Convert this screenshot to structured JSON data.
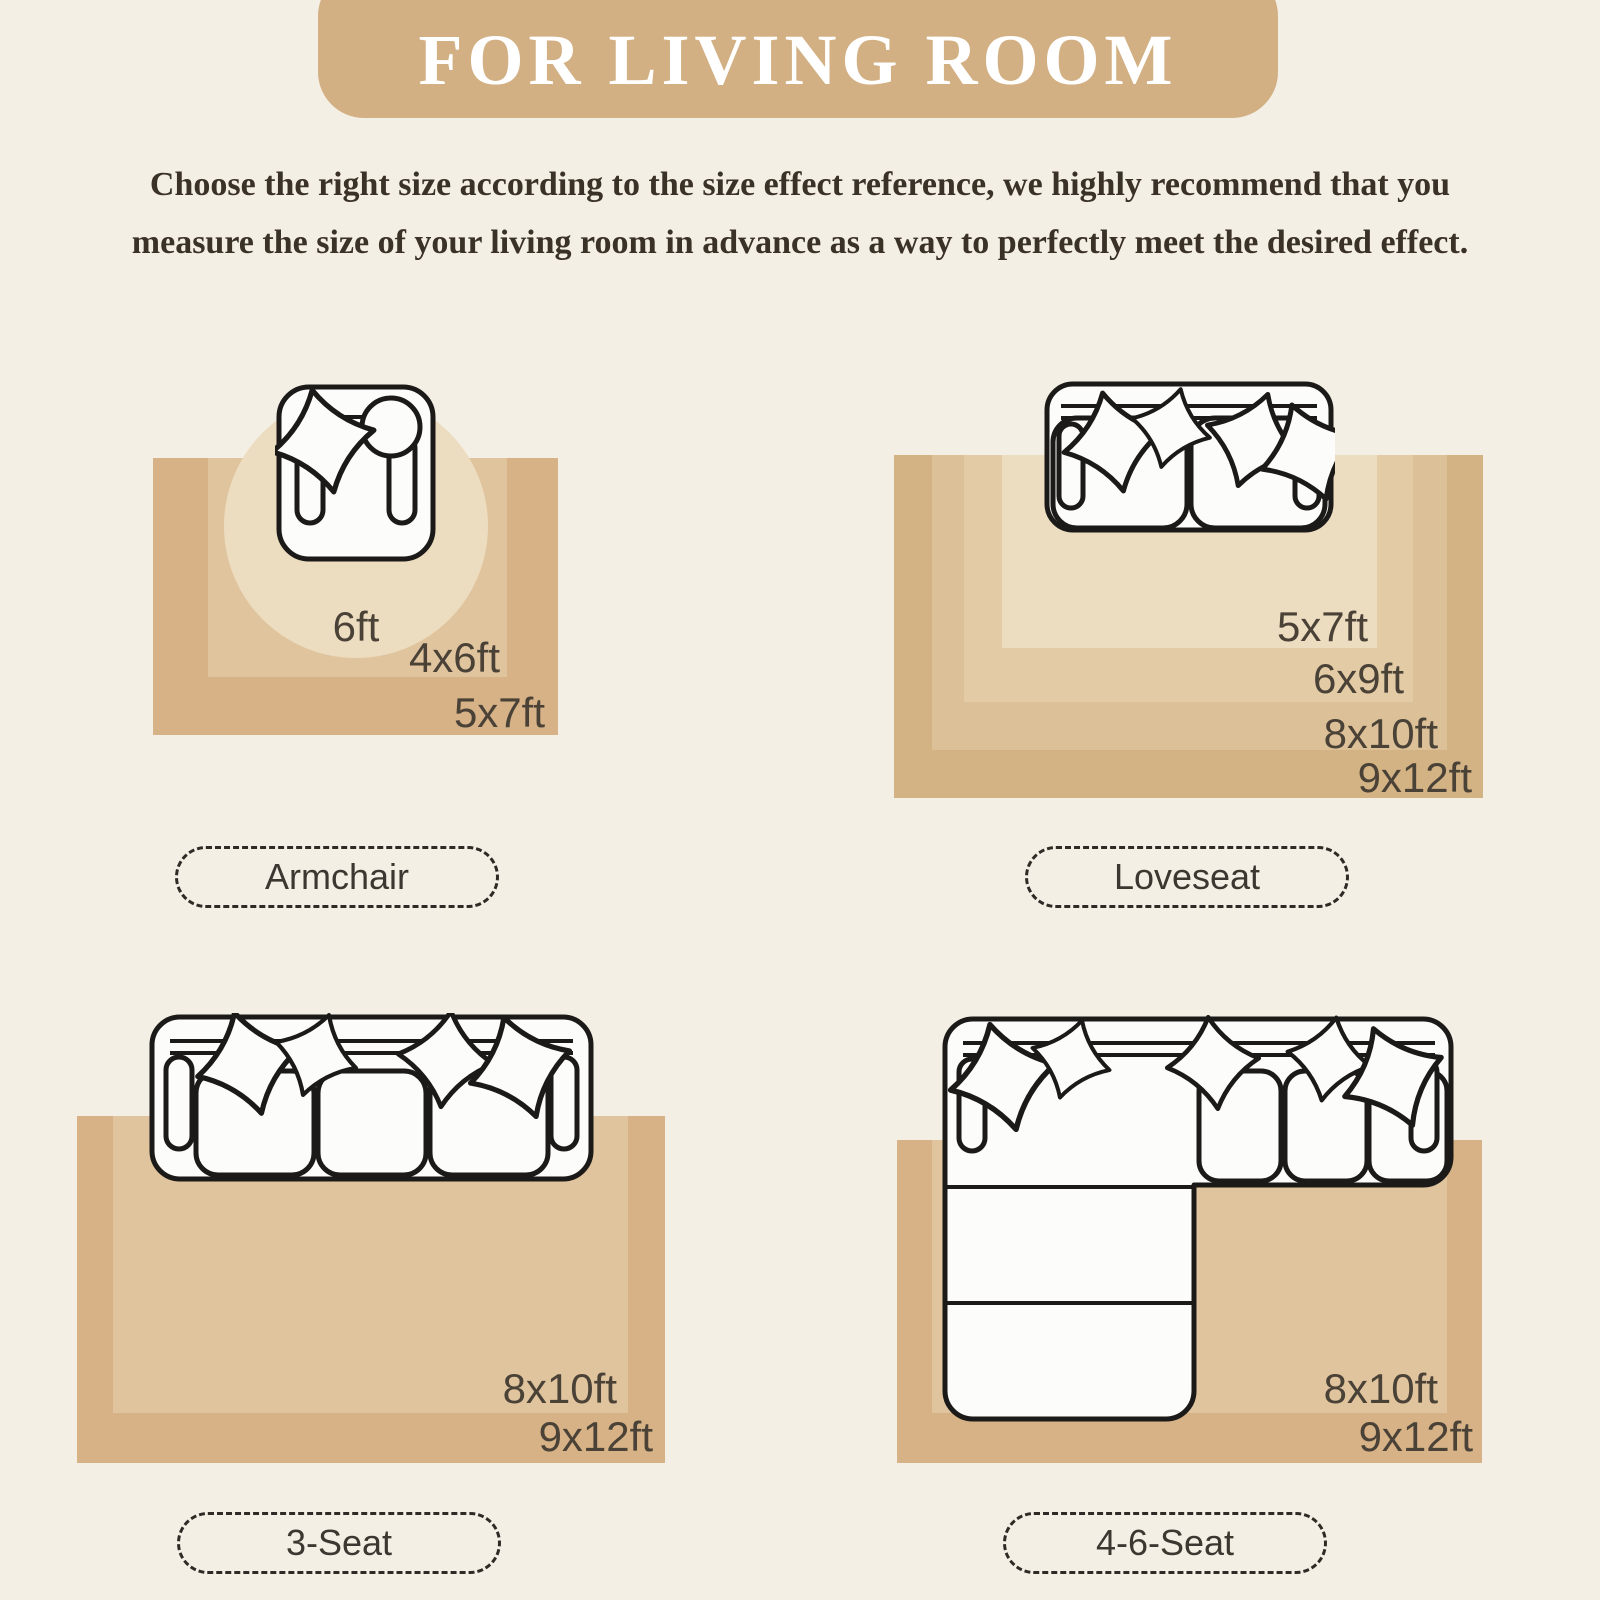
{
  "header": {
    "title": "FOR LIVING ROOM"
  },
  "intro": {
    "line1": "Choose the right size according to the size effect reference, we highly recommend that you",
    "line2": "measure the size of your living room in advance as a way to perfectly meet the desired effect."
  },
  "quadrants": {
    "armchair": {
      "label": "Armchair",
      "sizes": {
        "s1": "6ft",
        "s2": "4x6ft",
        "s3": "5x7ft"
      }
    },
    "loveseat": {
      "label": "Loveseat",
      "sizes": {
        "s1": "5x7ft",
        "s2": "6x9ft",
        "s3": "8x10ft",
        "s4": "9x12ft"
      }
    },
    "threeSeat": {
      "label": "3-Seat",
      "sizes": {
        "s1": "8x10ft",
        "s2": "9x12ft"
      }
    },
    "sectional": {
      "label": "4-6-Seat",
      "sizes": {
        "s1": "8x10ft",
        "s2": "9x12ft"
      }
    }
  },
  "colors": {
    "bg": "#f4efe4",
    "banner": "#d2b083",
    "banner-text": "#ffffff",
    "ink": "#3a3127",
    "label": "#4b4237",
    "pill-text": "#3c3831",
    "pill-border": "#2e2b26",
    "tone1": "#ecdcc0",
    "tone2": "#e3cba6",
    "tone3": "#dcc098",
    "tone4": "#d3b284",
    "rug-outer": "#d6b286",
    "rug-inner": "#e0c49e",
    "icon-line": "#1b1a18",
    "icon-fill": "#fcfcfb"
  }
}
